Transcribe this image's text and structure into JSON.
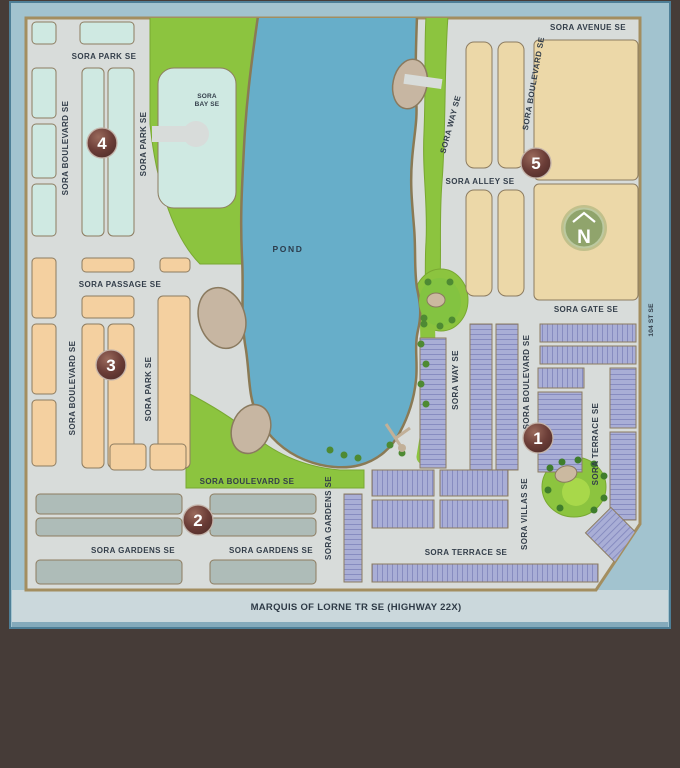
{
  "logo": {
    "main": "SOR",
    "accent": "A"
  },
  "colors": {
    "background_brown": "#463c38",
    "panel_blue": "#a2c3cf",
    "panel_band": "#cbd8dc",
    "road_gray": "#d8dcda",
    "pond": "#67aec9",
    "green": "#8cc43f",
    "phase1": "#a9aed6",
    "phase2": "#aebcb8",
    "phase3": "#f4d0a0",
    "phase4": "#cfe9e2",
    "phase5": "#ecd8a8",
    "blob_tan": "#c7b6a2",
    "marker_maroon": "#5d3531",
    "compass_green": "#90a46c"
  },
  "map": {
    "pond_label": "POND",
    "highway_label": "MARQUIS OF LORNE TR SE (HIGHWAY 22X)",
    "compass": "N",
    "phase_labels": [
      "1",
      "2",
      "3",
      "4",
      "5"
    ],
    "streets": {
      "park_top": "SORA PARK SE",
      "blvd_w_upper": "SORA BOULEVARD SE",
      "park_w_upper": "SORA PARK SE",
      "bay_line1": "SORA",
      "bay_line2": "BAY SE",
      "passage": "SORA PASSAGE SE",
      "blvd_w_lower": "SORA BOULEVARD SE",
      "park_w_lower": "SORA PARK SE",
      "blvd_south": "SORA BOULEVARD SE",
      "gardens_a": "SORA GARDENS SE",
      "gardens_b": "SORA GARDENS SE",
      "gardens_v": "SORA GARDENS SE",
      "avenue": "SORA AVENUE SE",
      "way_ne": "SORA WAY SE",
      "blvd_ne": "SORA BOULEVARD SE",
      "alley": "SORA ALLEY SE",
      "gate": "SORA GATE SE",
      "st104": "104 ST SE",
      "way_se": "SORA WAY SE",
      "blvd_se": "SORA BOULEVARD SE",
      "terrace_v": "SORA TERRACE SE",
      "villas": "SORA VILLAS SE",
      "terrace_h": "SORA TERRACE SE"
    }
  }
}
